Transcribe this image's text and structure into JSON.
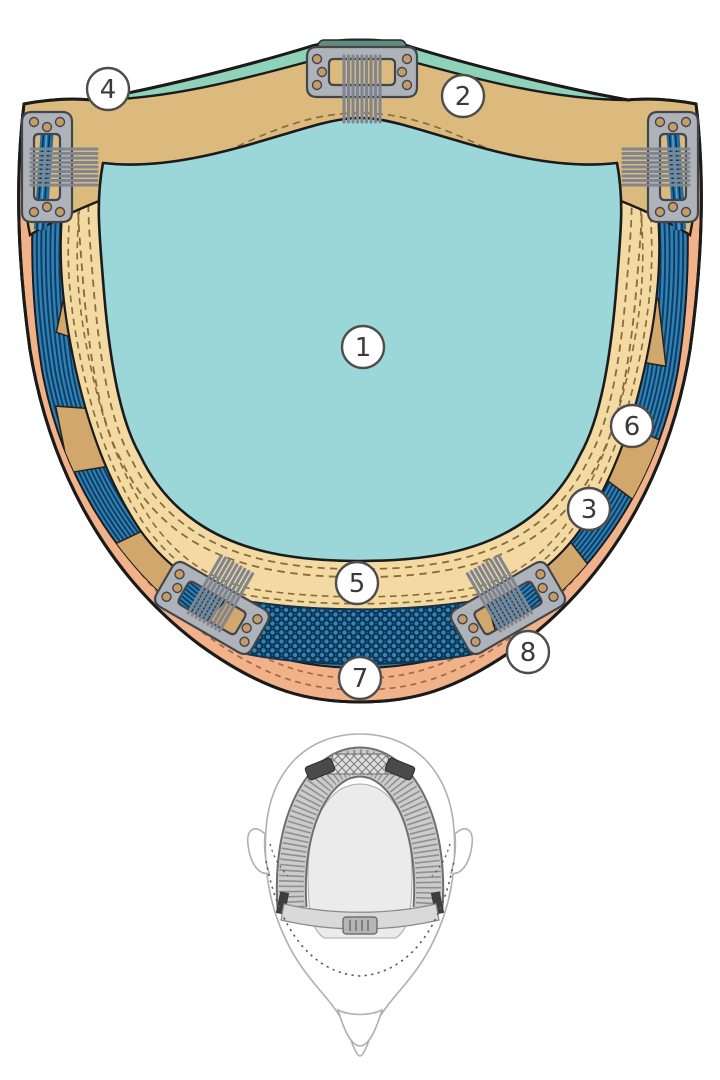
{
  "diagram": {
    "callouts": [
      "1",
      "2",
      "3",
      "4",
      "5",
      "6",
      "7",
      "8"
    ],
    "colors": {
      "monofilament_top": "#9bd7d8",
      "top_trim_green": "#8fd2ba",
      "front_band_tan": "#dcba7e",
      "inner_band_cream": "#f3d9a2",
      "ribbon_tan": "#d2a76c",
      "weft_blue": "#2e80b5",
      "weft_dark_blue": "#123e60",
      "mesh_navy": "#0d3350",
      "edge_band_peach": "#f1b189",
      "clip_metal_gray": "#aeb3ba",
      "clip_hole_copper": "#c79b66",
      "outline": "#1b1b1b"
    }
  }
}
